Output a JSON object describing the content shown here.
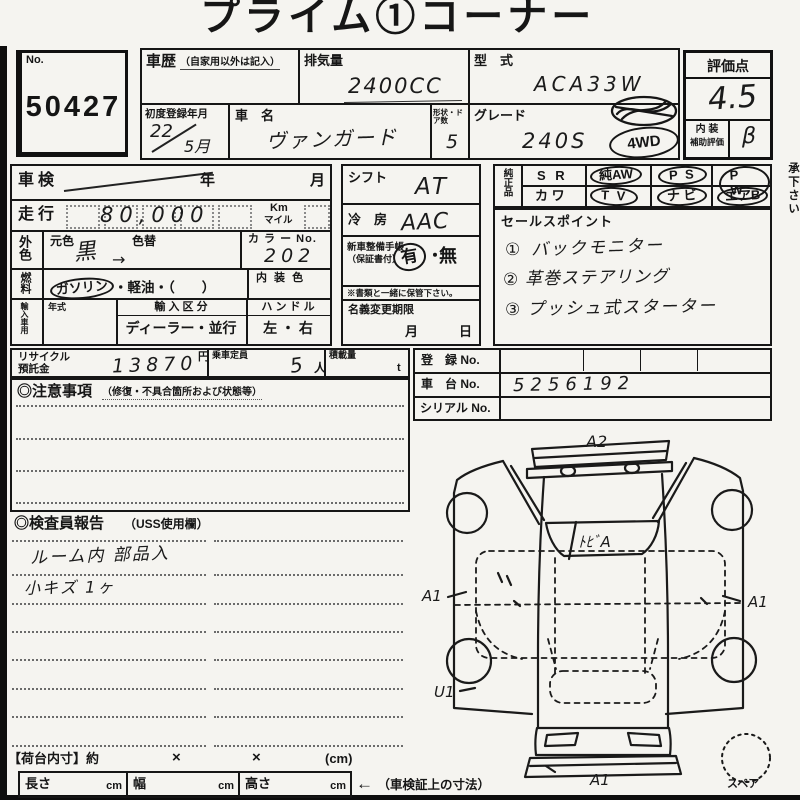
{
  "title": "プライム①コーナー",
  "lot": {
    "label": "No.",
    "number": "50427"
  },
  "header": {
    "history_label": "車歴",
    "history_sub": "（自家用以外は記入）",
    "displacement_label": "排気量",
    "displacement_value": "2400CC",
    "model_label": "型　式",
    "model_value": "ACA33W",
    "first_reg_label": "初度登録年月",
    "first_reg_value": "22",
    "first_reg_month": "5月",
    "name_label": "車　名",
    "name_value": "ヴァンガード",
    "doors_label": "形状・ドア数",
    "doors_value": "5",
    "grade_label": "グレード",
    "grade_value": "240S",
    "stamp_4wd": "4WD",
    "score_label": "評価点",
    "score_value": "4.5",
    "interior_label_1": "内 装",
    "interior_label_2": "補助評価",
    "interior_value": "β"
  },
  "left": {
    "shaken_label": "車検",
    "shaken_year": "年",
    "shaken_month": "月",
    "mileage_label": "走行",
    "mileage_value": "80,000",
    "unit_km": "Km",
    "unit_mile": "マイル",
    "color_label": "外色",
    "moto_label": "元色",
    "kae_label": "色替",
    "color_value": "黒",
    "color_arrow": "→",
    "colorno_label": "カ ラ ー No.",
    "colorno_value": "202",
    "fuel_label": "燃料",
    "fuel_opt1": "ガソリン",
    "fuel_rest": "・軽油・（　　）",
    "interior_color_label": "内 装 色",
    "import_label": "輸入車用",
    "nenshiki_label": "年式",
    "kubun_label": "輸 入 区 分",
    "kubun_value": "ディーラー・並行",
    "handle_label": "ハ ン ド ル",
    "handle_value": "左 ・ 右"
  },
  "mid": {
    "shift_label": "シフト",
    "shift_value": "AT",
    "ac_label": "冷　房",
    "ac_value": "AAC",
    "book_label_1": "新車整備手帳",
    "book_label_2": "（保証書付）",
    "book_yes": "有",
    "book_sep": "・",
    "book_no": "無",
    "book_note": "※書類と一緒に保管下さい。",
    "transfer_label": "名義変更期限",
    "transfer_month": "月",
    "transfer_day": "日"
  },
  "oem": {
    "header": "純正品",
    "r1c1": "S R",
    "r1c2": "純AW",
    "r1c3": "P S",
    "r1c4": "P W",
    "r2c1": "カ ワ",
    "r2c2": "T V",
    "r2c3": "ナ ビ",
    "r2c4": "エアB"
  },
  "sales": {
    "label": "セールスポイント",
    "item1_num": "①",
    "item1": "バックモニター",
    "item2_num": "②",
    "item2": "革巻ステアリング",
    "item3_num": "③",
    "item3": "プッシュ式スターター"
  },
  "reg": {
    "touroku_label": "登　録 No.",
    "chassis_label": "車　台 No.",
    "chassis_value": "5256192",
    "serial_label": "シリアル No."
  },
  "recycle": {
    "label1": "リサイクル",
    "label2": "預託金",
    "value": "13870",
    "yen": "円",
    "capacity_label": "乗車定員",
    "capacity_value": "5",
    "capacity_unit": "人",
    "load_label": "積載量",
    "load_unit": "t"
  },
  "notes": {
    "title": "◎注意事項",
    "sub": "（修復・不具合箇所および状態等）"
  },
  "inspector": {
    "title": "◎検査員報告",
    "sub": "（USS使用欄）",
    "line1": "ルーム内 部品入",
    "line2": "小キズ 1ヶ"
  },
  "diagram": {
    "top": "A2",
    "glass": "ﾄﾋﾞA",
    "left": "A1",
    "right": "A1",
    "bottom_left": "U1",
    "bottom": "A1",
    "spare_label": "スペア"
  },
  "cargo": {
    "title": "【荷台内寸】約",
    "times1": "×",
    "times2": "×",
    "unit": "(cm)",
    "len": "長さ",
    "wid": "幅",
    "hei": "高さ",
    "cm": "cm",
    "note_arrow": "←",
    "note": "（車検証上の寸法）"
  },
  "side_note": "◆純正品に関する表示は出品店の申告です（ナビ・TV等）※あらかじめご了承下さい",
  "colors": {
    "line": "#151515",
    "paper": "#f5f4f0",
    "hand": "#1b1b1b"
  }
}
